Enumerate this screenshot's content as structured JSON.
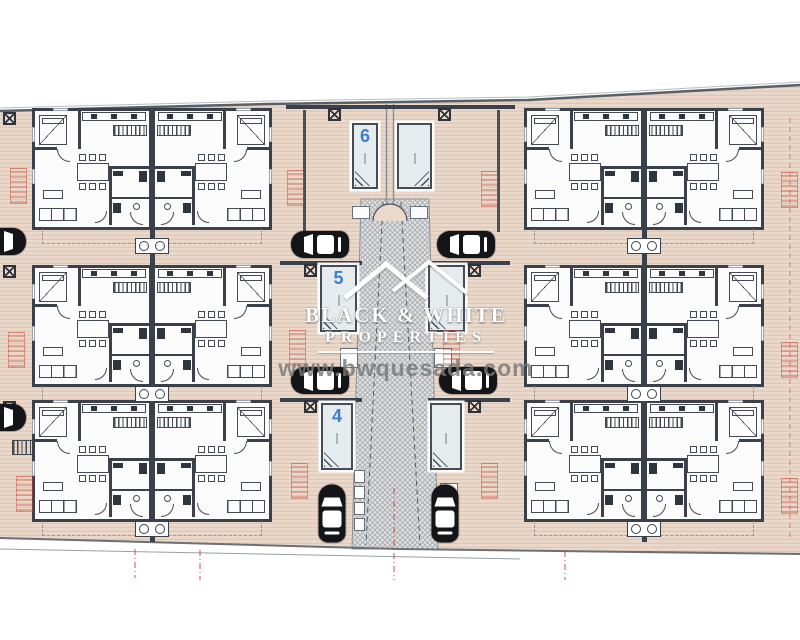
{
  "plan": {
    "type": "site-floor-plan",
    "buildings_count": 6,
    "units_per_building": 2
  },
  "pools": [
    {
      "label": "6"
    },
    {
      "label": "5"
    },
    {
      "label": "4"
    }
  ],
  "watermark": {
    "name_line1": "BLACK & WHITE",
    "name_line2": "PROPERTIES",
    "website": "www.bwquesada.com"
  },
  "colors": {
    "ground": "#ead9ca",
    "ground_lines": "#c9a28d",
    "walls": "#3b414b",
    "walkway": "#dfe1e2",
    "pool_fill": "#e6ecee",
    "pool_number_blue": "#3c7fd2",
    "stamp_red": "#c44637",
    "watermark_gray": "#787878"
  }
}
